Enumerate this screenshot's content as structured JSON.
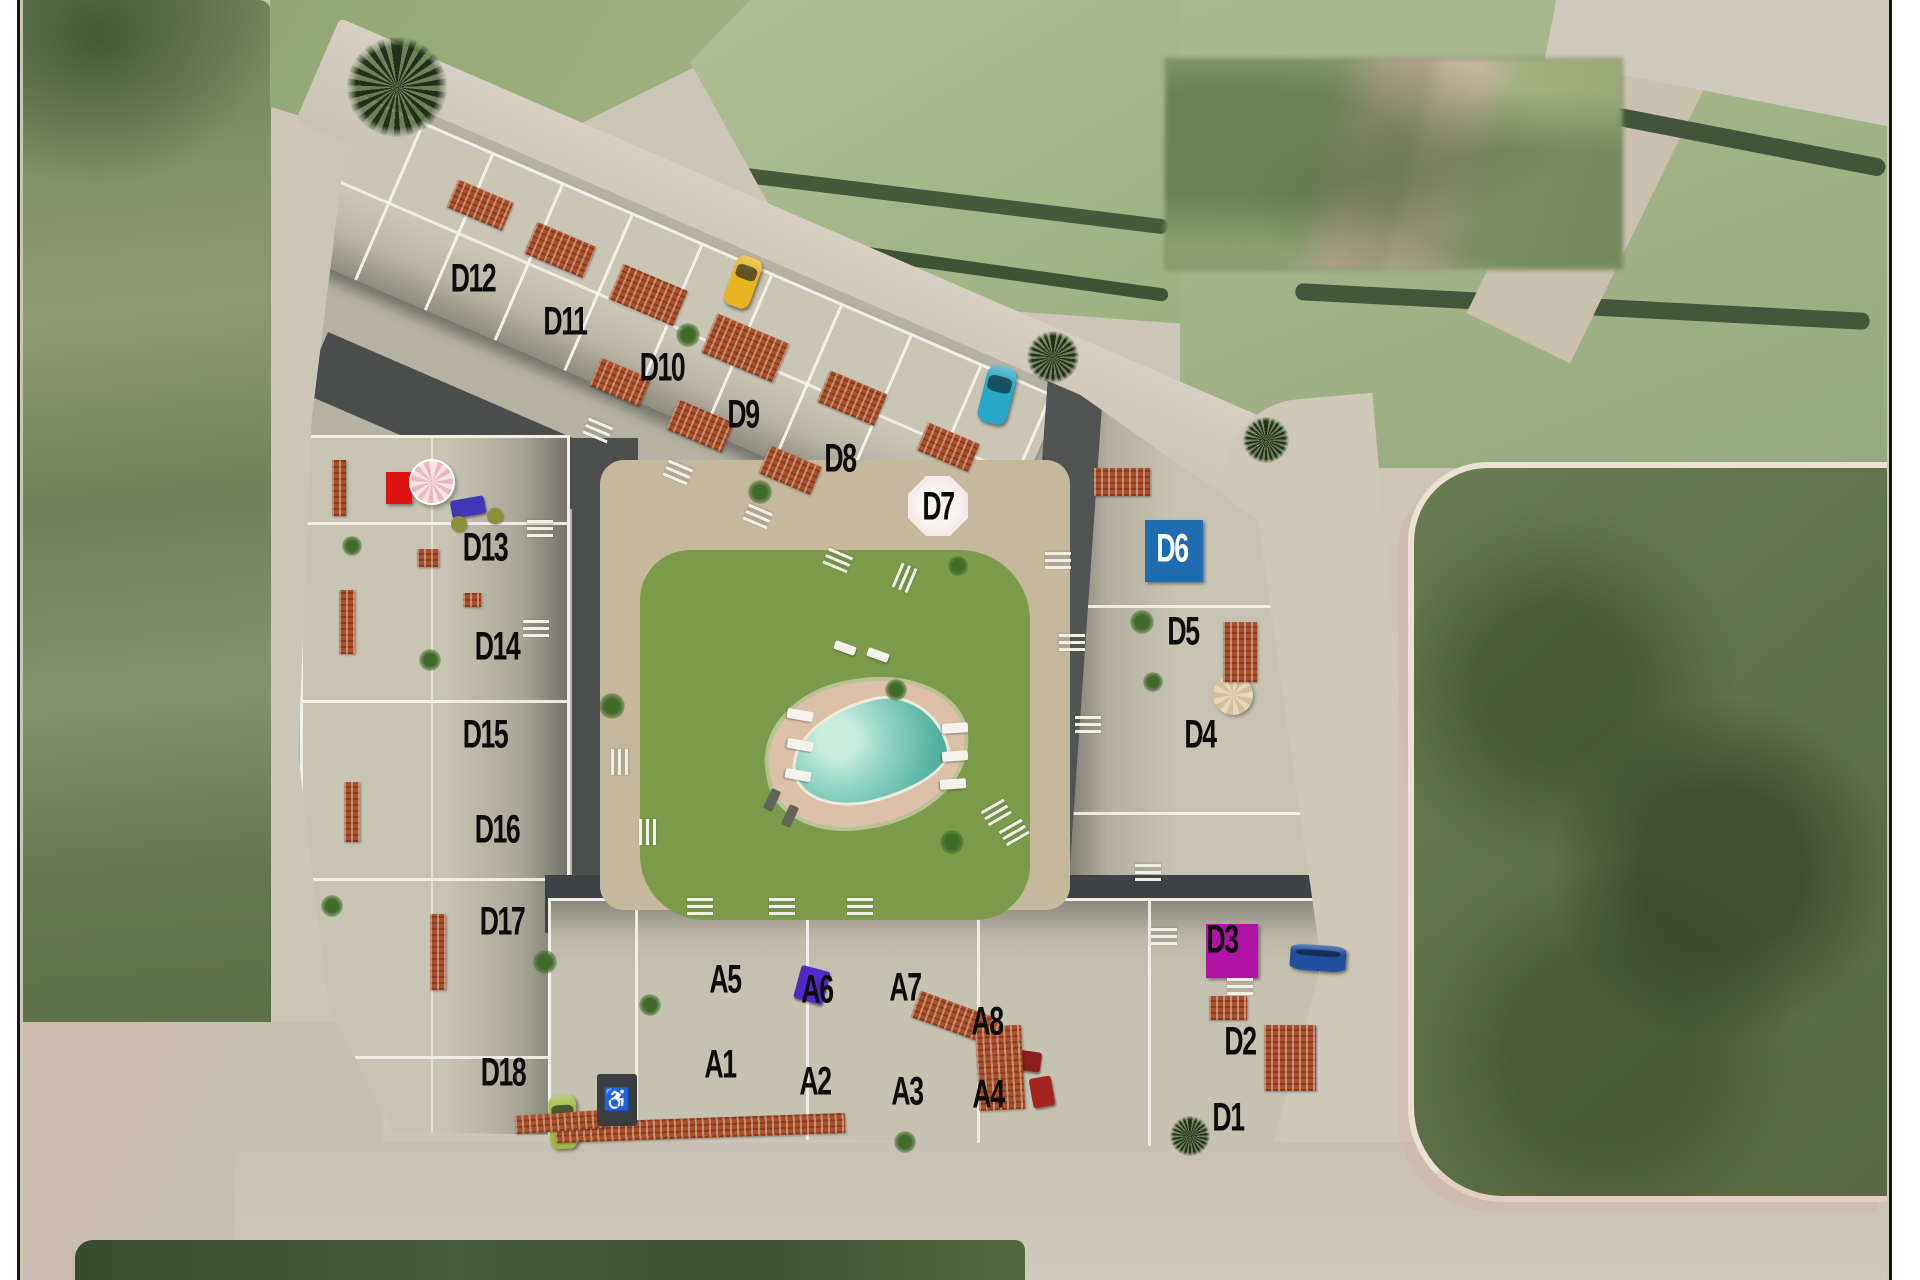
{
  "map": {
    "unit_labels": [
      {
        "id": "D12",
        "x": 473,
        "y": 279
      },
      {
        "id": "D11",
        "x": 565,
        "y": 322
      },
      {
        "id": "D10",
        "x": 662,
        "y": 368
      },
      {
        "id": "D9",
        "x": 743,
        "y": 415
      },
      {
        "id": "D8",
        "x": 840,
        "y": 459
      },
      {
        "id": "D7",
        "x": 938,
        "y": 507
      },
      {
        "id": "D6",
        "x": 1172,
        "y": 549,
        "color": "#ffffff"
      },
      {
        "id": "D5",
        "x": 1183,
        "y": 632
      },
      {
        "id": "D4",
        "x": 1200,
        "y": 735
      },
      {
        "id": "D13",
        "x": 485,
        "y": 548
      },
      {
        "id": "D14",
        "x": 497,
        "y": 647
      },
      {
        "id": "D15",
        "x": 485,
        "y": 735
      },
      {
        "id": "D16",
        "x": 497,
        "y": 830
      },
      {
        "id": "D17",
        "x": 502,
        "y": 922
      },
      {
        "id": "D18",
        "x": 503,
        "y": 1073
      },
      {
        "id": "A5",
        "x": 725,
        "y": 980
      },
      {
        "id": "A6",
        "x": 817,
        "y": 990
      },
      {
        "id": "A7",
        "x": 905,
        "y": 988
      },
      {
        "id": "A8",
        "x": 987,
        "y": 1022
      },
      {
        "id": "A1",
        "x": 720,
        "y": 1065
      },
      {
        "id": "A2",
        "x": 815,
        "y": 1082
      },
      {
        "id": "A3",
        "x": 907,
        "y": 1092
      },
      {
        "id": "A4",
        "x": 988,
        "y": 1095
      },
      {
        "id": "D3",
        "x": 1222,
        "y": 940
      },
      {
        "id": "D2",
        "x": 1240,
        "y": 1042
      },
      {
        "id": "D1",
        "x": 1228,
        "y": 1118
      }
    ],
    "features": [
      {
        "type": "square",
        "x": 1174,
        "y": 551,
        "w": 58,
        "h": 62,
        "color": "#1e6db3"
      },
      {
        "type": "square",
        "x": 1232,
        "y": 951,
        "w": 52,
        "h": 54,
        "color": "#b013a5"
      },
      {
        "type": "square",
        "x": 399,
        "y": 488,
        "w": 26,
        "h": 32,
        "color": "#e01212"
      },
      {
        "type": "umbrella-pink",
        "x": 432,
        "y": 482,
        "r": 23
      },
      {
        "type": "umbrella-white",
        "x": 938,
        "y": 506,
        "r": 30
      },
      {
        "type": "umbrella-tan",
        "x": 1233,
        "y": 695,
        "r": 20
      },
      {
        "type": "sofa",
        "x": 468,
        "y": 507,
        "w": 34,
        "h": 18,
        "rot": -10,
        "color": "#4136b5"
      },
      {
        "type": "pouf",
        "x": 459,
        "y": 524,
        "r": 8,
        "color": "#8f8f37"
      },
      {
        "type": "pouf",
        "x": 495,
        "y": 516,
        "r": 8,
        "color": "#8f8f37"
      },
      {
        "type": "sofa",
        "x": 812,
        "y": 985,
        "w": 30,
        "h": 34,
        "rot": 15,
        "color": "#5228c8"
      },
      {
        "type": "sofa",
        "x": 1021,
        "y": 1060,
        "w": 40,
        "h": 20,
        "rot": 8,
        "color": "#8c1f1c"
      },
      {
        "type": "sofa",
        "x": 1042,
        "y": 1092,
        "w": 22,
        "h": 30,
        "rot": -10,
        "color": "#a32420"
      },
      {
        "type": "car",
        "x": 743,
        "y": 282,
        "w": 27,
        "h": 52,
        "rot": 20,
        "color": "#e8b520"
      },
      {
        "type": "car",
        "x": 997,
        "y": 395,
        "w": 30,
        "h": 58,
        "rot": 14,
        "color": "#27a8c8"
      },
      {
        "type": "car",
        "x": 1318,
        "y": 958,
        "w": 56,
        "h": 26,
        "rot": 4,
        "color": "#1f4f9e"
      },
      {
        "type": "car",
        "x": 563,
        "y": 1122,
        "w": 28,
        "h": 54,
        "rot": -3,
        "color": "#9fb93f"
      },
      {
        "type": "roof",
        "x": 480,
        "y": 205,
        "w": 60,
        "h": 30,
        "rot": 23
      },
      {
        "type": "roof",
        "x": 560,
        "y": 250,
        "w": 64,
        "h": 34,
        "rot": 23
      },
      {
        "type": "roof",
        "x": 648,
        "y": 295,
        "w": 70,
        "h": 38,
        "rot": 23
      },
      {
        "type": "roof",
        "x": 745,
        "y": 348,
        "w": 78,
        "h": 42,
        "rot": 23
      },
      {
        "type": "roof",
        "x": 852,
        "y": 398,
        "w": 62,
        "h": 34,
        "rot": 23
      },
      {
        "type": "roof",
        "x": 948,
        "y": 447,
        "w": 56,
        "h": 30,
        "rot": 23
      },
      {
        "type": "roof",
        "x": 620,
        "y": 382,
        "w": 54,
        "h": 30,
        "rot": 23
      },
      {
        "type": "roof",
        "x": 700,
        "y": 426,
        "w": 60,
        "h": 32,
        "rot": 23
      },
      {
        "type": "roof",
        "x": 790,
        "y": 470,
        "w": 56,
        "h": 30,
        "rot": 23
      },
      {
        "type": "roof",
        "x": 428,
        "y": 558,
        "w": 22,
        "h": 18,
        "rot": 0
      },
      {
        "type": "roof",
        "x": 472,
        "y": 600,
        "w": 18,
        "h": 14,
        "rot": 0
      },
      {
        "type": "roof",
        "x": 347,
        "y": 622,
        "w": 16,
        "h": 64,
        "rot": 0
      },
      {
        "type": "roof",
        "x": 339,
        "y": 488,
        "w": 14,
        "h": 56,
        "rot": 0
      },
      {
        "type": "roof",
        "x": 438,
        "y": 952,
        "w": 16,
        "h": 76,
        "rot": 0
      },
      {
        "type": "roof",
        "x": 352,
        "y": 812,
        "w": 16,
        "h": 60,
        "rot": 0
      },
      {
        "type": "roof",
        "x": 700,
        "y": 1128,
        "w": 290,
        "h": 20,
        "rot": -2
      },
      {
        "type": "roof",
        "x": 560,
        "y": 1122,
        "w": 90,
        "h": 18,
        "rot": -4
      },
      {
        "type": "roof",
        "x": 955,
        "y": 1018,
        "w": 84,
        "h": 28,
        "rot": 20
      },
      {
        "type": "roof",
        "x": 1000,
        "y": 1068,
        "w": 46,
        "h": 84,
        "rot": -3
      },
      {
        "type": "roof",
        "x": 1122,
        "y": 482,
        "w": 56,
        "h": 28,
        "rot": 0
      },
      {
        "type": "roof",
        "x": 1240,
        "y": 652,
        "w": 34,
        "h": 60,
        "rot": 0
      },
      {
        "type": "roof",
        "x": 1290,
        "y": 1058,
        "w": 52,
        "h": 66,
        "rot": 0
      },
      {
        "type": "roof",
        "x": 1228,
        "y": 1008,
        "w": 38,
        "h": 24,
        "rot": 0
      },
      {
        "type": "palm",
        "x": 397,
        "y": 87,
        "r": 50
      },
      {
        "type": "palm",
        "x": 1053,
        "y": 357,
        "r": 26
      },
      {
        "type": "palm",
        "x": 1266,
        "y": 440,
        "r": 23
      },
      {
        "type": "palm",
        "x": 1190,
        "y": 1136,
        "r": 20
      },
      {
        "type": "plant",
        "x": 688,
        "y": 335,
        "r": 12
      },
      {
        "type": "plant",
        "x": 760,
        "y": 492,
        "r": 12
      },
      {
        "type": "plant",
        "x": 612,
        "y": 706,
        "r": 13
      },
      {
        "type": "plant",
        "x": 896,
        "y": 690,
        "r": 11
      },
      {
        "type": "plant",
        "x": 1142,
        "y": 622,
        "r": 12
      },
      {
        "type": "plant",
        "x": 952,
        "y": 842,
        "r": 12
      },
      {
        "type": "plant",
        "x": 545,
        "y": 962,
        "r": 12
      },
      {
        "type": "plant",
        "x": 430,
        "y": 660,
        "r": 11
      },
      {
        "type": "plant",
        "x": 352,
        "y": 546,
        "r": 10
      },
      {
        "type": "plant",
        "x": 1153,
        "y": 682,
        "r": 10
      },
      {
        "type": "plant",
        "x": 958,
        "y": 566,
        "r": 10
      },
      {
        "type": "plant",
        "x": 332,
        "y": 906,
        "r": 11
      },
      {
        "type": "plant",
        "x": 650,
        "y": 1005,
        "r": 11
      },
      {
        "type": "plant",
        "x": 905,
        "y": 1142,
        "r": 11
      },
      {
        "type": "lounger",
        "x": 800,
        "y": 715,
        "w": 10,
        "h": 26,
        "rot": 100
      },
      {
        "type": "lounger",
        "x": 800,
        "y": 745,
        "w": 10,
        "h": 26,
        "rot": 100
      },
      {
        "type": "lounger",
        "x": 798,
        "y": 775,
        "w": 10,
        "h": 26,
        "rot": 100
      },
      {
        "type": "lounger",
        "x": 955,
        "y": 728,
        "w": 10,
        "h": 26,
        "rot": 86
      },
      {
        "type": "lounger",
        "x": 955,
        "y": 756,
        "w": 10,
        "h": 26,
        "rot": 86
      },
      {
        "type": "lounger",
        "x": 953,
        "y": 784,
        "w": 10,
        "h": 26,
        "rot": 86
      },
      {
        "type": "lounger",
        "x": 845,
        "y": 648,
        "w": 22,
        "h": 9,
        "rot": 20
      },
      {
        "type": "lounger",
        "x": 878,
        "y": 655,
        "w": 22,
        "h": 9,
        "rot": 20
      },
      {
        "type": "lounger-dark",
        "x": 772,
        "y": 800,
        "w": 22,
        "h": 10,
        "rot": 115
      },
      {
        "type": "lounger-dark",
        "x": 790,
        "y": 816,
        "w": 22,
        "h": 10,
        "rot": 115
      },
      {
        "type": "stairs",
        "x": 598,
        "y": 430,
        "w": 26,
        "h": 18,
        "rot": 23
      },
      {
        "type": "stairs",
        "x": 678,
        "y": 472,
        "w": 26,
        "h": 18,
        "rot": 23
      },
      {
        "type": "stairs",
        "x": 758,
        "y": 516,
        "w": 26,
        "h": 18,
        "rot": 23
      },
      {
        "type": "stairs",
        "x": 838,
        "y": 560,
        "w": 26,
        "h": 18,
        "rot": 23
      },
      {
        "type": "stairs",
        "x": 540,
        "y": 528,
        "w": 26,
        "h": 18,
        "rot": 0
      },
      {
        "type": "stairs",
        "x": 536,
        "y": 628,
        "w": 26,
        "h": 18,
        "rot": 0
      },
      {
        "type": "stairs",
        "x": 620,
        "y": 762,
        "w": 26,
        "h": 18,
        "rot": 90
      },
      {
        "type": "stairs",
        "x": 648,
        "y": 832,
        "w": 26,
        "h": 18,
        "rot": 90
      },
      {
        "type": "stairs",
        "x": 700,
        "y": 906,
        "w": 26,
        "h": 18,
        "rot": 0
      },
      {
        "type": "stairs",
        "x": 782,
        "y": 906,
        "w": 26,
        "h": 18,
        "rot": 0
      },
      {
        "type": "stairs",
        "x": 860,
        "y": 906,
        "w": 26,
        "h": 18,
        "rot": 0
      },
      {
        "type": "stairs",
        "x": 1058,
        "y": 560,
        "w": 26,
        "h": 18,
        "rot": 0
      },
      {
        "type": "stairs",
        "x": 1072,
        "y": 642,
        "w": 26,
        "h": 18,
        "rot": 0
      },
      {
        "type": "stairs",
        "x": 1088,
        "y": 724,
        "w": 26,
        "h": 18,
        "rot": 0
      },
      {
        "type": "stairs",
        "x": 1148,
        "y": 872,
        "w": 26,
        "h": 18,
        "rot": 0
      },
      {
        "type": "stairs",
        "x": 1164,
        "y": 936,
        "w": 26,
        "h": 18,
        "rot": 0
      },
      {
        "type": "stairs",
        "x": 1240,
        "y": 986,
        "w": 26,
        "h": 18,
        "rot": 0
      },
      {
        "type": "stairs",
        "x": 996,
        "y": 812,
        "w": 26,
        "h": 18,
        "rot": -30
      },
      {
        "type": "stairs",
        "x": 1014,
        "y": 832,
        "w": 26,
        "h": 18,
        "rot": -30
      },
      {
        "type": "stairs",
        "x": 905,
        "y": 578,
        "w": 26,
        "h": 18,
        "rot": 113
      },
      {
        "type": "badge",
        "x": 617,
        "y": 1100,
        "w": 40,
        "h": 52,
        "color": "#3a3d3f",
        "glyph": "♿"
      }
    ],
    "palette": {
      "road": "#ccc5b8",
      "field_dark": "#5d7047",
      "field_light": "#a9b98e",
      "building": "#c7c3b3",
      "wall_white": "#f1efe8",
      "shadow": "#4a4d4b",
      "terracotta": "#a9512d",
      "lawn": "#7b9b4b",
      "pool_water": "#8ed2c1",
      "pool_deck": "#dcc0a8",
      "marker_blue": "#1e6db3",
      "marker_magenta": "#b013a5",
      "label_color": "#0c0c0c"
    }
  }
}
